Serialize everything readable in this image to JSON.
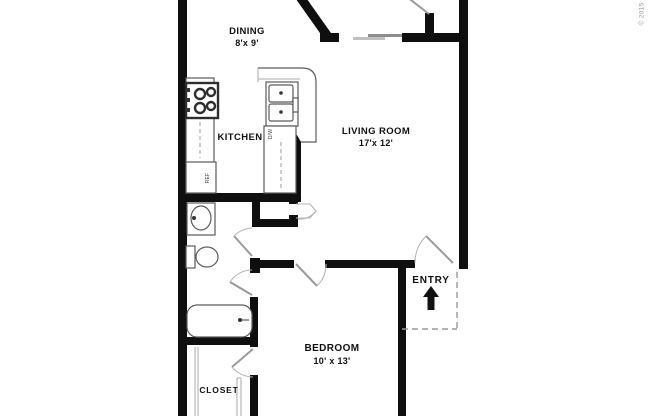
{
  "copyright": "© 2015",
  "colors": {
    "wall": "#0f0f0f",
    "fixture": "#5a5a5a",
    "light": "#aaaaaa",
    "door": "#9a9a9a",
    "text": "#101010",
    "muted": "#9a9a9a",
    "bg": "#ffffff"
  },
  "rooms": {
    "dining": {
      "label": "DINING",
      "dims": "8'x 9'"
    },
    "kitchen": {
      "label": "KITCHEN"
    },
    "living_room": {
      "label": "LIVING ROOM",
      "dims": "17'x 12'"
    },
    "bedroom": {
      "label": "BEDROOM",
      "dims": "10' x 13'"
    },
    "closet": {
      "label": "CLOSET"
    },
    "entry": {
      "label": "ENTRY"
    }
  },
  "appliances": {
    "refrigerator_label": "REF",
    "dishwasher_label": "D/W"
  },
  "icons": {
    "entry_arrow": "up-arrow"
  }
}
